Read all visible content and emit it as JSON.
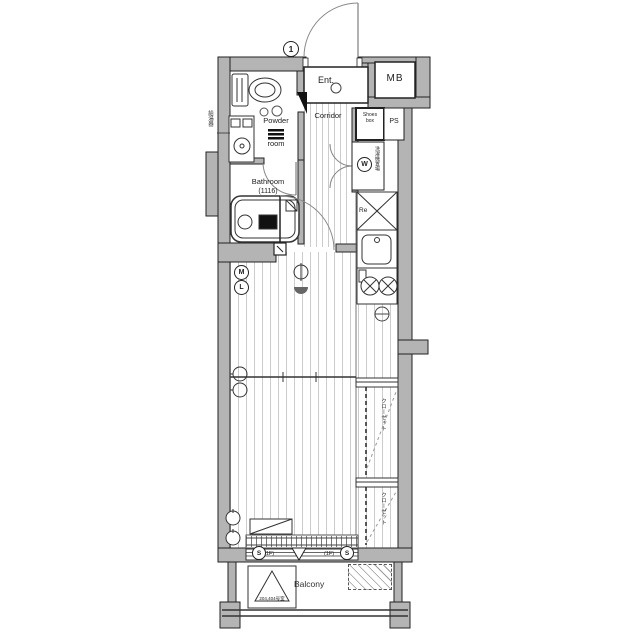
{
  "title": "apartment-floor-plan",
  "colors": {
    "wall": "#b4b4b4",
    "line": "#222222",
    "floor_stripe": "#cccccc",
    "background": "#ffffff"
  },
  "labels": {
    "door_number": "1",
    "entrance": "Ent.",
    "meter_box": "MB",
    "shoes_box_line1": "Shoes",
    "shoes_box_line2": "box",
    "pipe_space": "PS",
    "corridor": "Corridor",
    "powder_line1": "Powder",
    "powder_line2": "room",
    "washer_symbol": "W",
    "washer_space_vertical": "洗濯機置場",
    "bathroom": "Bathroom",
    "bathroom_size": "(1116)",
    "refrigerator": "Re",
    "symbol_m": "M",
    "symbol_l": "L",
    "closet_vertical_1": "クローゼット",
    "closet_vertical_2": "クローゼット",
    "water_heater_vertical": "給湯器",
    "window_s_left": "S",
    "window_s_right": "S",
    "floor_1f_left": "(1F)",
    "floor_1f_right": "(1F)",
    "balcony": "Balcony",
    "room_numbers": "204,404号室"
  }
}
